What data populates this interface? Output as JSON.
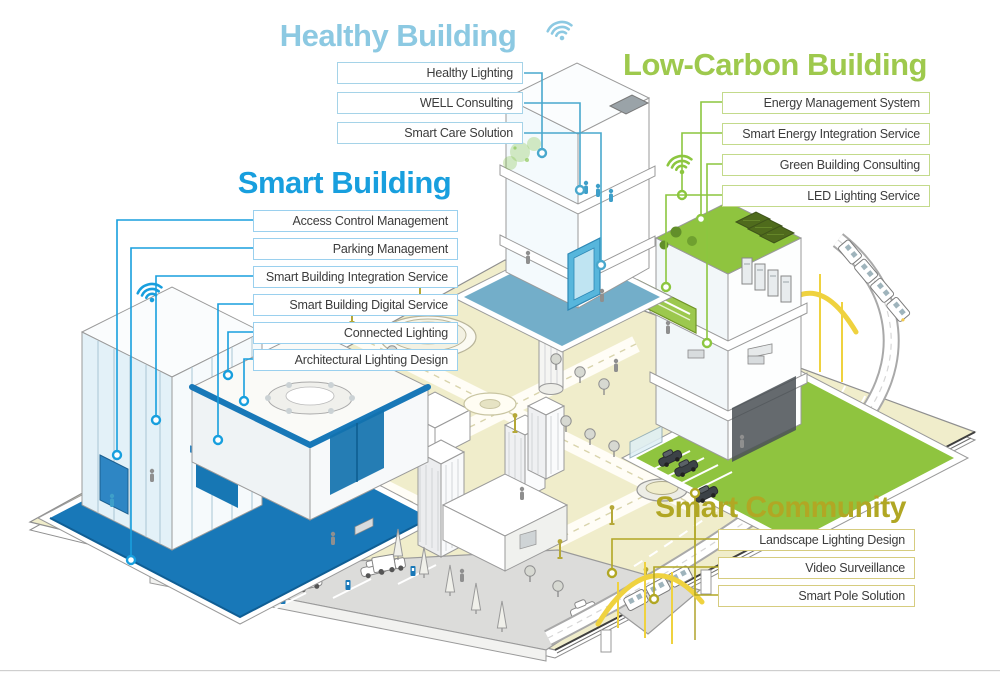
{
  "theme": {
    "healthy": "#8CC9E2",
    "healthy_border": "#A5D3E8",
    "healthy_line": "#49A8CD",
    "smart": "#189FDE",
    "smart_border": "#9AD0EE",
    "carbon": "#9EC94D",
    "carbon_border": "#C3DA8B",
    "carbon_dark": "#8CC63F",
    "community": "#B1A724",
    "community_border": "#D6CC7F",
    "platform_blue": "#1878B8",
    "platform_teal": "#73AEC9",
    "platform_green": "#8FC43F",
    "ground": "#F0EDCB",
    "bridge_yellow": "#EFD23F",
    "lamp_olive": "#B5A838"
  },
  "sections": {
    "healthy_building": {
      "title": "Healthy Building",
      "labels": [
        "Healthy Lighting",
        "WELL Consulting",
        "Smart Care Solution"
      ]
    },
    "smart_building": {
      "title": "Smart Building",
      "labels": [
        "Access Control Management",
        "Parking Management",
        "Smart Building Integration Service",
        "Smart Building Digital Service",
        "Connected Lighting",
        "Architectural Lighting Design"
      ]
    },
    "low_carbon_building": {
      "title": "Low-Carbon Building",
      "labels": [
        "Energy Management System",
        "Smart Energy Integration Service",
        "Green Building Consulting",
        "LED Lighting Service"
      ]
    },
    "smart_community": {
      "title": "Smart Community",
      "labels": [
        "Landscape Lighting Design",
        "Video Surveillance",
        "Smart Pole Solution"
      ]
    }
  }
}
